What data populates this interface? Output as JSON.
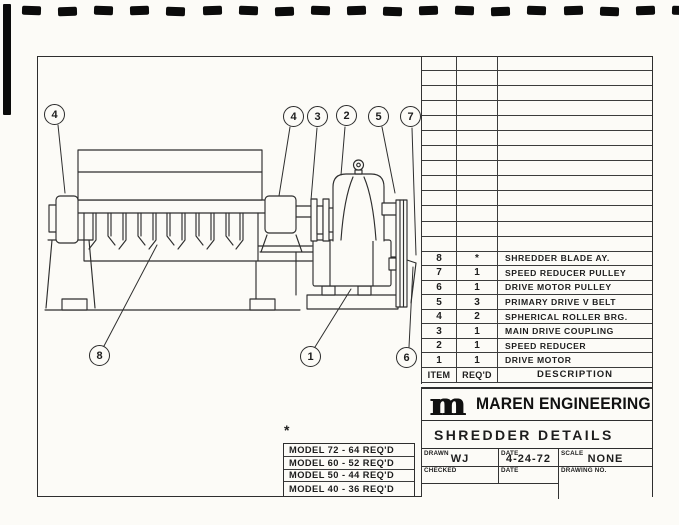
{
  "callouts": [
    {
      "label": "4"
    },
    {
      "label": "4"
    },
    {
      "label": "3"
    },
    {
      "label": "2"
    },
    {
      "label": "5"
    },
    {
      "label": "7"
    },
    {
      "label": "8"
    },
    {
      "label": "1"
    },
    {
      "label": "6"
    }
  ],
  "parts_table": {
    "empty_row_count": 13,
    "headers": {
      "item": "ITEM",
      "reqd": "REQ'D",
      "description": "DESCRIPTION"
    },
    "rows": [
      {
        "item": "8",
        "reqd": "*",
        "description": "SHREDDER BLADE AY."
      },
      {
        "item": "7",
        "reqd": "1",
        "description": "SPEED REDUCER PULLEY"
      },
      {
        "item": "6",
        "reqd": "1",
        "description": "DRIVE MOTOR PULLEY"
      },
      {
        "item": "5",
        "reqd": "3",
        "description": "PRIMARY DRIVE V BELT"
      },
      {
        "item": "4",
        "reqd": "2",
        "description": "SPHERICAL ROLLER BRG."
      },
      {
        "item": "3",
        "reqd": "1",
        "description": "MAIN DRIVE COUPLING"
      },
      {
        "item": "2",
        "reqd": "1",
        "description": "SPEED REDUCER"
      },
      {
        "item": "1",
        "reqd": "1",
        "description": "DRIVE MOTOR"
      }
    ]
  },
  "model_table": {
    "note": "*",
    "rows": [
      {
        "text": "MODEL 72 - 64 REQ'D"
      },
      {
        "text": "MODEL 60 - 52 REQ'D"
      },
      {
        "text": "MODEL 50 - 44 REQ'D"
      },
      {
        "text": "MODEL 40 - 36 REQ'D"
      }
    ]
  },
  "title_block": {
    "company": "MAREN ENGINEERING",
    "logo_glyph": "m",
    "drawing_title": "SHREDDER DETAILS",
    "drawn_label": "DRAWN",
    "drawn_value": "WJ",
    "date_label": "DATE",
    "date_value": "4-24-72",
    "scale_label": "SCALE",
    "scale_value": "NONE",
    "checked_label": "CHECKED",
    "checked_date_label": "DATE",
    "drawing_no_label": "DRAWING NO."
  }
}
